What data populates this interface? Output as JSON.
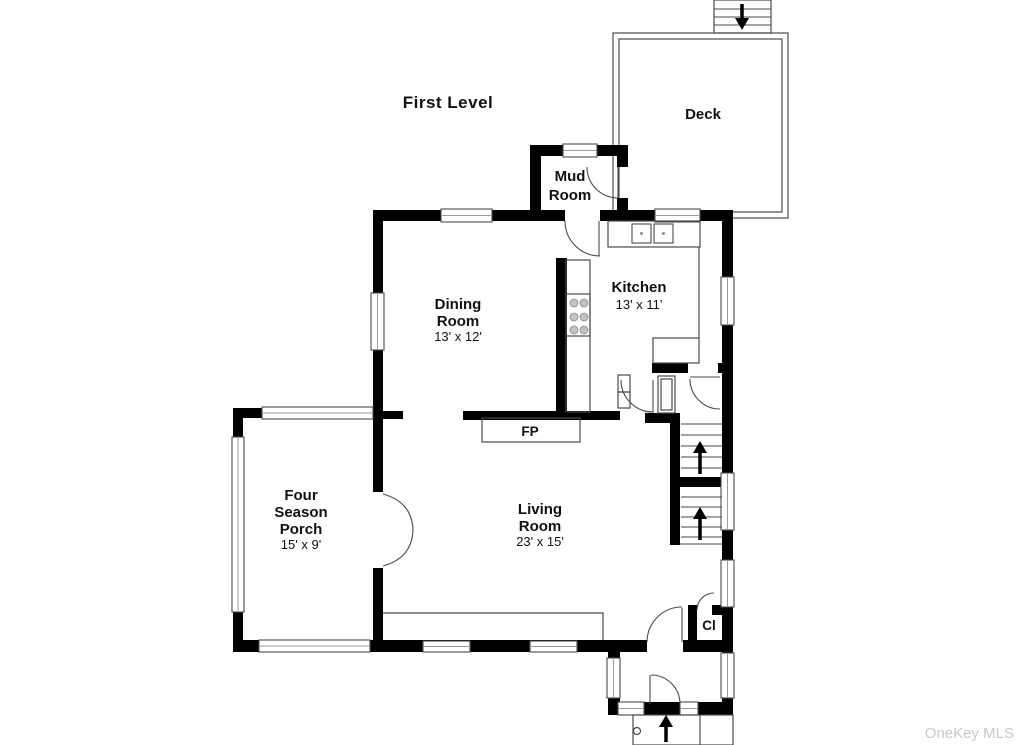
{
  "title": "First Level",
  "watermark": "OneKey MLS",
  "colors": {
    "wall": "#000000",
    "bg": "#ffffff",
    "line": "#4a4a4a",
    "line_light": "#9a9a9a",
    "watermark": "#c8c8c8",
    "text": "#111111"
  },
  "rooms": {
    "deck": {
      "name": "Deck"
    },
    "mud_room": {
      "name_line1": "Mud",
      "name_line2": "Room"
    },
    "kitchen": {
      "name": "Kitchen",
      "dims": "13' x 11'"
    },
    "dining_room": {
      "name_line1": "Dining",
      "name_line2": "Room",
      "dims": "13' x 12'"
    },
    "four_season_porch": {
      "name_line1": "Four",
      "name_line2": "Season",
      "name_line3": "Porch",
      "dims": "15' x 9'"
    },
    "living_room": {
      "name_line1": "Living",
      "name_line2": "Room",
      "dims": "23' x 15'"
    },
    "fireplace": {
      "abbr": "FP"
    },
    "closet": {
      "abbr": "Cl"
    }
  }
}
